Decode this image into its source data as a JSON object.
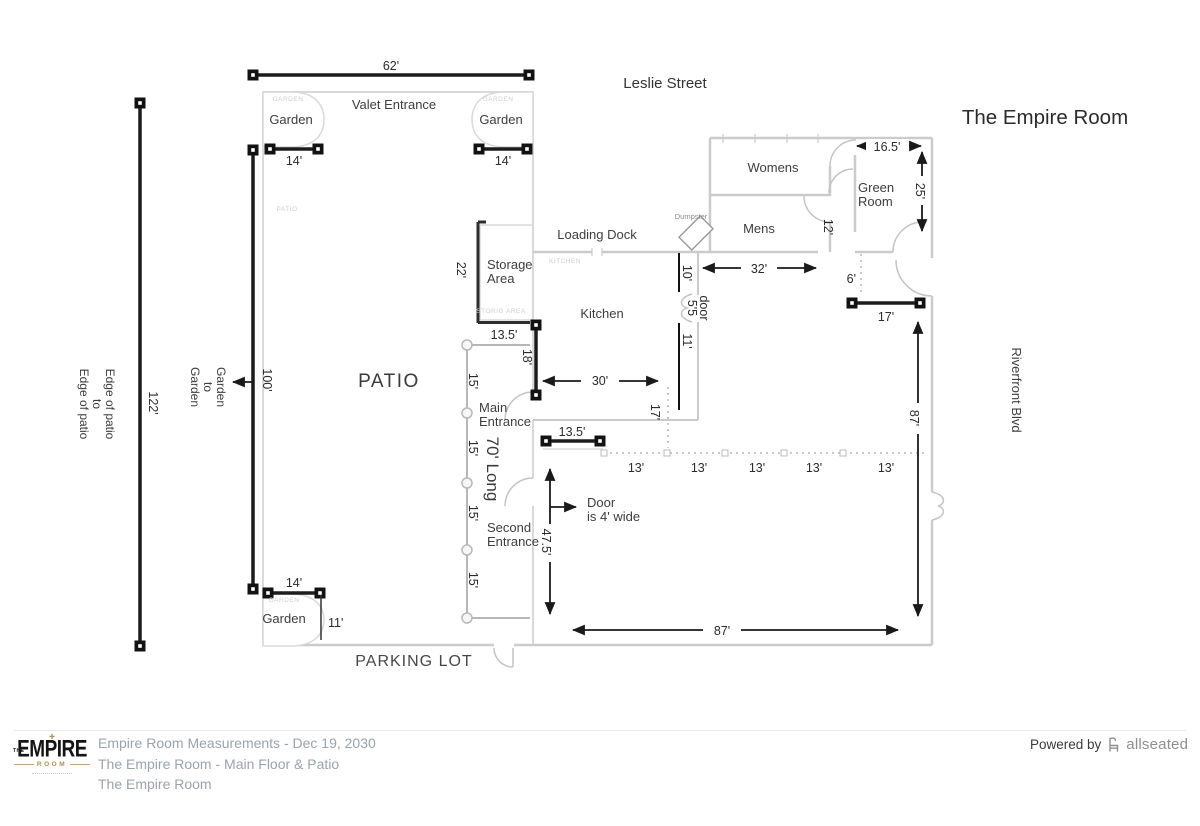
{
  "plan": {
    "title": "The Empire Room",
    "street_top": "Leslie Street",
    "street_right": "Riverfront Blvd",
    "parking": "PARKING LOT",
    "patio": "PATIO",
    "valet": "Valet Entrance",
    "garden": "Garden",
    "loading_dock": "Loading Dock",
    "kitchen": "Kitchen",
    "storage1": "Storage",
    "storage2": "Area",
    "womens": "Womens",
    "mens": "Mens",
    "green1": "Green",
    "green2": "Room",
    "dumpster": "Dumpster",
    "main1": "Main",
    "main2": "Entrance",
    "second1": "Second",
    "second2": "Entrance",
    "door_note1": "Door",
    "door_note2": "is 4' wide",
    "edge_note1": "Edge of patio",
    "edge_note2": "to",
    "edge_note3": "Edge of patio",
    "g2g1": "Garden",
    "g2g2": "to",
    "g2g3": "Garden"
  },
  "watermarks": {
    "garden": "GARDEN",
    "patio": "PATIO",
    "kitchen": "KITCHEN",
    "storage": "STORIG AREA"
  },
  "dims": {
    "d62": "62'",
    "d14": "14'",
    "d122": "122'",
    "d100": "100'",
    "d22": "22'",
    "d13_5": "13.5'",
    "d18": "18'",
    "d30": "30'",
    "d10": "10'",
    "d5_5": "5'5",
    "door_word": "door",
    "d11": "11'",
    "d32": "32'",
    "d16_5": "16.5'",
    "d25": "25'",
    "d12": "12'",
    "d6": "6'",
    "d17": "17'",
    "d87": "87'",
    "d47_5": "47.5'",
    "d13": "13'",
    "d15": "15'",
    "d70": "70' Long"
  },
  "footer": {
    "line1": "Empire Room Measurements - Dec 19, 2030",
    "line2": "The Empire Room - Main Floor & Patio",
    "line3": "The Empire Room",
    "powered_by": "Powered by",
    "brand": "allseated",
    "logo_the": "THE",
    "logo_empire": "EMPIRE",
    "logo_room": "ROOM"
  }
}
